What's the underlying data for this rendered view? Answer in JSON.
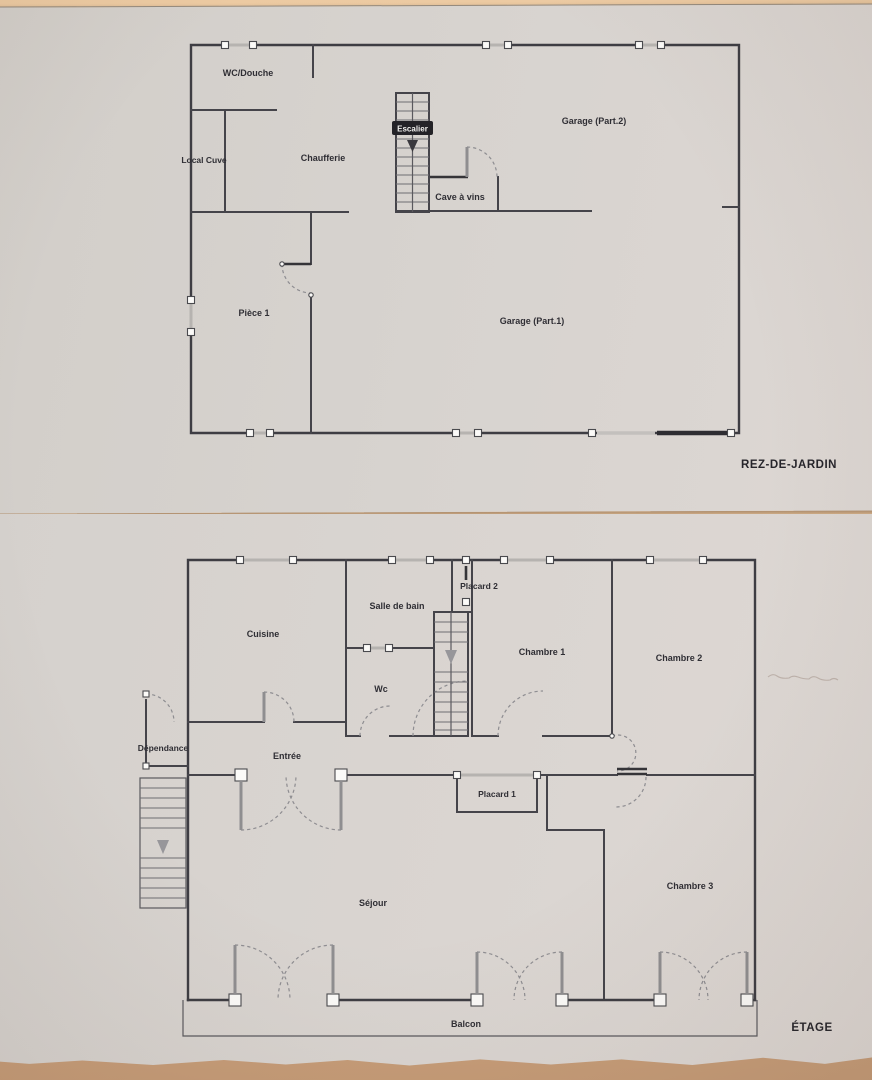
{
  "plans": {
    "rdj": {
      "title": "REZ-DE-JARDIN",
      "rooms": {
        "wc_douche": "WC/Douche",
        "chaufferie": "Chaufferie",
        "local_cuve": "Local Cuve",
        "escalier": "Escalier",
        "cave_a_vins": "Cave à vins",
        "garage_part2": "Garage (Part.2)",
        "garage_part1": "Garage (Part.1)",
        "piece_1": "Pièce 1"
      }
    },
    "etage": {
      "title": "ÉTAGE",
      "rooms": {
        "cuisine": "Cuisine",
        "salle_de_bain": "Salle de bain",
        "placard_2": "Placard 2",
        "chambre_1": "Chambre 1",
        "chambre_2": "Chambre 2",
        "wc": "Wc",
        "dependance": "Dépendance",
        "entree": "Entrée",
        "placard_1": "Placard 1",
        "sejour": "Séjour",
        "chambre_3": "Chambre 3",
        "balcon": "Balcon"
      }
    }
  },
  "colors": {
    "paper": "#d7d3cf",
    "table": "#d9b38c",
    "wall_line": "#45444a",
    "label_text": "#2f2e34"
  }
}
